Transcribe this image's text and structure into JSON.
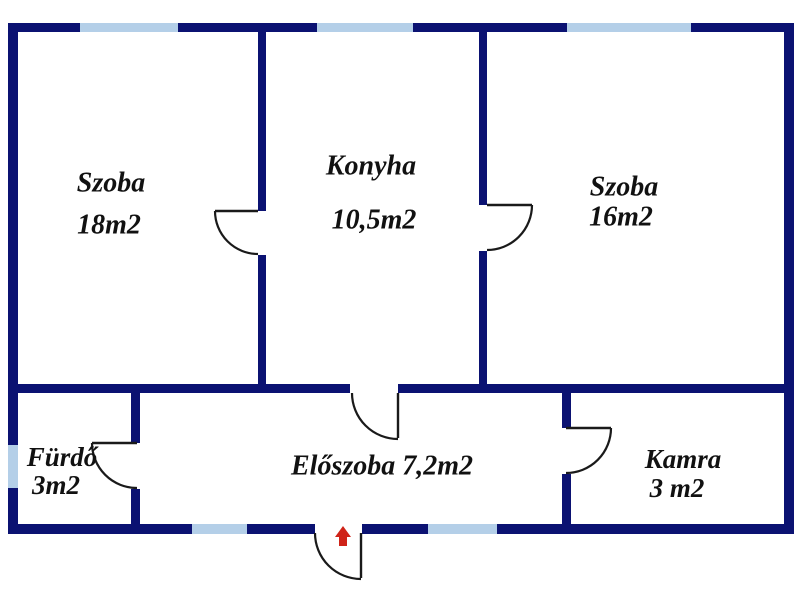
{
  "plan": {
    "type": "floor-plan",
    "canvas": {
      "w": 800,
      "h": 600
    },
    "palette": {
      "background": "#ffffff",
      "wall": "#0b1272",
      "window": "#b4cfe8",
      "door_stroke": "#1a1a1a",
      "label_text": "#111111",
      "entrance_arrow": "#cf2318"
    },
    "rooms": [
      {
        "name": "Szoba",
        "area": "18m2"
      },
      {
        "name": "Konyha",
        "area": "10,5m2"
      },
      {
        "name": "Szoba",
        "area": "16m2"
      },
      {
        "name": "Fürdő",
        "area": "3m2"
      },
      {
        "name": "Előszoba",
        "area": "7,2m2"
      },
      {
        "name": "Kamra",
        "area": "3 m2"
      }
    ],
    "labels": [
      {
        "id": "room-label-szoba18-name",
        "text": "Szoba",
        "x": 111,
        "y": 185,
        "size": 28
      },
      {
        "id": "room-label-szoba18-area",
        "text": "18m2",
        "x": 109,
        "y": 227,
        "size": 28
      },
      {
        "id": "room-label-konyha-name",
        "text": "Konyha",
        "x": 371,
        "y": 168,
        "size": 28
      },
      {
        "id": "room-label-konyha-area",
        "text": "10,5m2",
        "x": 374,
        "y": 222,
        "size": 28
      },
      {
        "id": "room-label-szoba16-name",
        "text": "Szoba",
        "x": 624,
        "y": 189,
        "size": 28
      },
      {
        "id": "room-label-szoba16-area",
        "text": "16m2",
        "x": 621,
        "y": 219,
        "size": 28
      },
      {
        "id": "room-label-furdo-name",
        "text": "Fürdő",
        "x": 62,
        "y": 460,
        "size": 27
      },
      {
        "id": "room-label-furdo-area",
        "text": "3m2",
        "x": 56,
        "y": 488,
        "size": 27
      },
      {
        "id": "room-label-eloszoba",
        "text": "Előszoba 7,2m2",
        "x": 382,
        "y": 468,
        "size": 28
      },
      {
        "id": "room-label-kamra-name",
        "text": "Kamra",
        "x": 683,
        "y": 462,
        "size": 27
      },
      {
        "id": "room-label-kamra-area",
        "text": "3 m2",
        "x": 677,
        "y": 491,
        "size": 27
      }
    ],
    "walls": [
      {
        "id": "outer-top",
        "x": 8,
        "y": 23,
        "w": 786,
        "h": 9
      },
      {
        "id": "outer-left",
        "x": 8,
        "y": 23,
        "w": 10,
        "h": 511
      },
      {
        "id": "outer-right",
        "x": 784,
        "y": 23,
        "w": 10,
        "h": 511
      },
      {
        "id": "outer-bottom-left",
        "x": 8,
        "y": 524,
        "w": 307,
        "h": 10
      },
      {
        "id": "outer-bottom-right",
        "x": 362,
        "y": 524,
        "w": 432,
        "h": 10
      },
      {
        "id": "mid-horizontal-left",
        "x": 8,
        "y": 384,
        "w": 342,
        "h": 9
      },
      {
        "id": "mid-horizontal-right",
        "x": 398,
        "y": 384,
        "w": 396,
        "h": 9
      },
      {
        "id": "divider-szoba18-upper",
        "x": 258,
        "y": 32,
        "w": 8,
        "h": 179
      },
      {
        "id": "divider-szoba18-lower",
        "x": 258,
        "y": 255,
        "w": 8,
        "h": 129
      },
      {
        "id": "divider-szoba16-upper",
        "x": 479,
        "y": 32,
        "w": 8,
        "h": 173
      },
      {
        "id": "divider-szoba16-lower",
        "x": 479,
        "y": 251,
        "w": 8,
        "h": 133
      },
      {
        "id": "divider-furdo-upper",
        "x": 131,
        "y": 393,
        "w": 9,
        "h": 50
      },
      {
        "id": "divider-furdo-lower",
        "x": 131,
        "y": 489,
        "w": 9,
        "h": 35
      },
      {
        "id": "divider-kamra-upper",
        "x": 562,
        "y": 393,
        "w": 9,
        "h": 35
      },
      {
        "id": "divider-kamra-lower",
        "x": 562,
        "y": 474,
        "w": 9,
        "h": 50
      }
    ],
    "windows": [
      {
        "id": "window-top-szoba18",
        "x": 80,
        "y": 23,
        "w": 98,
        "h": 9
      },
      {
        "id": "window-top-konyha",
        "x": 317,
        "y": 23,
        "w": 96,
        "h": 9
      },
      {
        "id": "window-top-szoba16",
        "x": 567,
        "y": 23,
        "w": 124,
        "h": 9
      },
      {
        "id": "window-left-furdo",
        "x": 8,
        "y": 445,
        "w": 10,
        "h": 43
      },
      {
        "id": "window-bottom-left",
        "x": 192,
        "y": 524,
        "w": 55,
        "h": 10
      },
      {
        "id": "window-bottom-right",
        "x": 428,
        "y": 524,
        "w": 69,
        "h": 10
      }
    ],
    "doors": [
      {
        "id": "door-szoba18",
        "leaf": [
          [
            258,
            211
          ],
          [
            215,
            211
          ]
        ],
        "arc": {
          "from": [
            215,
            211
          ],
          "to": [
            258,
            254
          ],
          "r": 43,
          "sweep": 0
        }
      },
      {
        "id": "door-szoba16",
        "leaf": [
          [
            487,
            205
          ],
          [
            532,
            205
          ]
        ],
        "arc": {
          "from": [
            532,
            205
          ],
          "to": [
            487,
            250
          ],
          "r": 45,
          "sweep": 1
        }
      },
      {
        "id": "door-konyha-eloszoba",
        "leaf": [
          [
            398,
            393
          ],
          [
            398,
            438
          ]
        ],
        "arc": {
          "from": [
            352,
            393
          ],
          "to": [
            398,
            439
          ],
          "r": 46,
          "sweep": 0
        }
      },
      {
        "id": "door-furdo",
        "leaf": [
          [
            137,
            443
          ],
          [
            92,
            443
          ]
        ],
        "arc": {
          "from": [
            92,
            443
          ],
          "to": [
            137,
            488
          ],
          "r": 45,
          "sweep": 0
        }
      },
      {
        "id": "door-kamra",
        "leaf": [
          [
            566,
            428
          ],
          [
            611,
            428
          ]
        ],
        "arc": {
          "from": [
            611,
            428
          ],
          "to": [
            566,
            473
          ],
          "r": 45,
          "sweep": 1
        }
      },
      {
        "id": "door-entrance",
        "leaf": [
          [
            361,
            533
          ],
          [
            361,
            578
          ]
        ],
        "arc": {
          "from": [
            315,
            533
          ],
          "to": [
            361,
            579
          ],
          "r": 46,
          "sweep": 0
        }
      }
    ],
    "entrance_arrow": {
      "id": "entrance-arrow",
      "direction": "up",
      "points": "343,526 351,537 347,537 347,546 339,546 339,537 335,537"
    }
  }
}
